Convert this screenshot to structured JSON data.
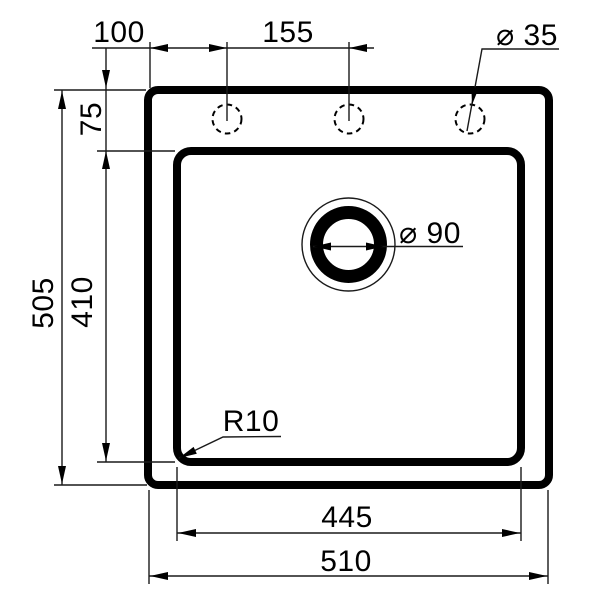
{
  "drawing": {
    "type": "sink-dimension-drawing",
    "background_color": "#ffffff",
    "line_color": "#000000",
    "labels": {
      "faucet_offset": "100",
      "faucet_spacing": "155",
      "faucet_hole_diameter": "⌀ 35",
      "rim_to_basin": "75",
      "overall_depth": "505",
      "basin_depth": "410",
      "drain_diameter": "⌀ 90",
      "corner_radius": "R10",
      "basin_width": "445",
      "overall_width": "510"
    }
  }
}
